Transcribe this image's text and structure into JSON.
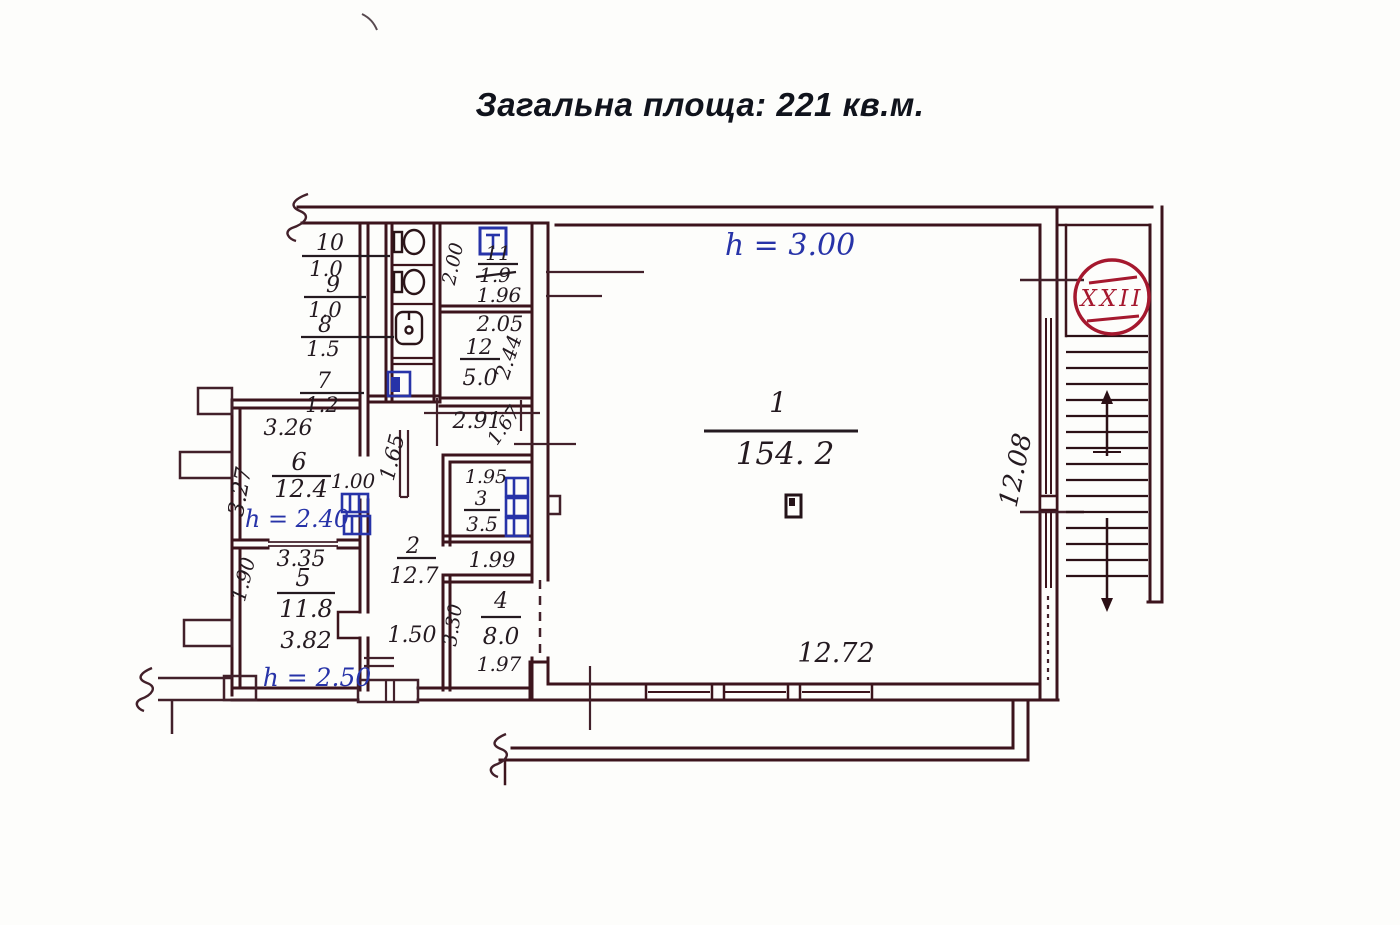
{
  "page": {
    "title": "Загальна площа: 221 кв.м."
  },
  "plan": {
    "stamp_text": "XXII",
    "colors": {
      "wall": "#3c141c",
      "ink": "#241a20",
      "blue": "#2733a8",
      "stamp": "#a5182e"
    },
    "heights": {
      "hall": "h = 3.00",
      "room6": "h = 2.40",
      "room5": "h = 2.50"
    },
    "rooms": {
      "r1": {
        "number": "1",
        "area": "154. 2"
      },
      "r2": {
        "number": "2",
        "area": "12.7"
      },
      "r3": {
        "number": "3",
        "area": "3.5"
      },
      "r4": {
        "number": "4",
        "area": "8.0"
      },
      "r5": {
        "number": "5",
        "area": "11.8"
      },
      "r6": {
        "number": "6",
        "area": "12.4"
      },
      "r7": {
        "number": "7",
        "area": "1.2"
      },
      "r8": {
        "number": "8",
        "area": "1.5"
      },
      "r9": {
        "number": "9",
        "area": "1.0"
      },
      "r10": {
        "number": "10",
        "area": "1.0"
      },
      "r11": {
        "number": "11",
        "area": "1.9"
      },
      "r12": {
        "number": "12",
        "area": "5.0"
      }
    },
    "dims": {
      "hall_bottom": "12.72",
      "stair_side": "12.08",
      "corridor_width": "2.91",
      "corridor_depth": "1.65",
      "corridor_diag": "1.67",
      "room11_width": "1.96",
      "room11_depth": "2.00",
      "room12_width": "2.05",
      "room12_depth": "2.44",
      "room6_top": "3.26",
      "room6_left": "3.27",
      "room6_door": "1.00",
      "room6_bottom": "3.35",
      "room5_left": "1.90",
      "room5_bottom": "3.82",
      "room2_door": "1.50",
      "room3_top": "1.95",
      "room3_bottom": "1.99",
      "room4_left": "3.30",
      "room4_bottom": "1.97"
    }
  }
}
